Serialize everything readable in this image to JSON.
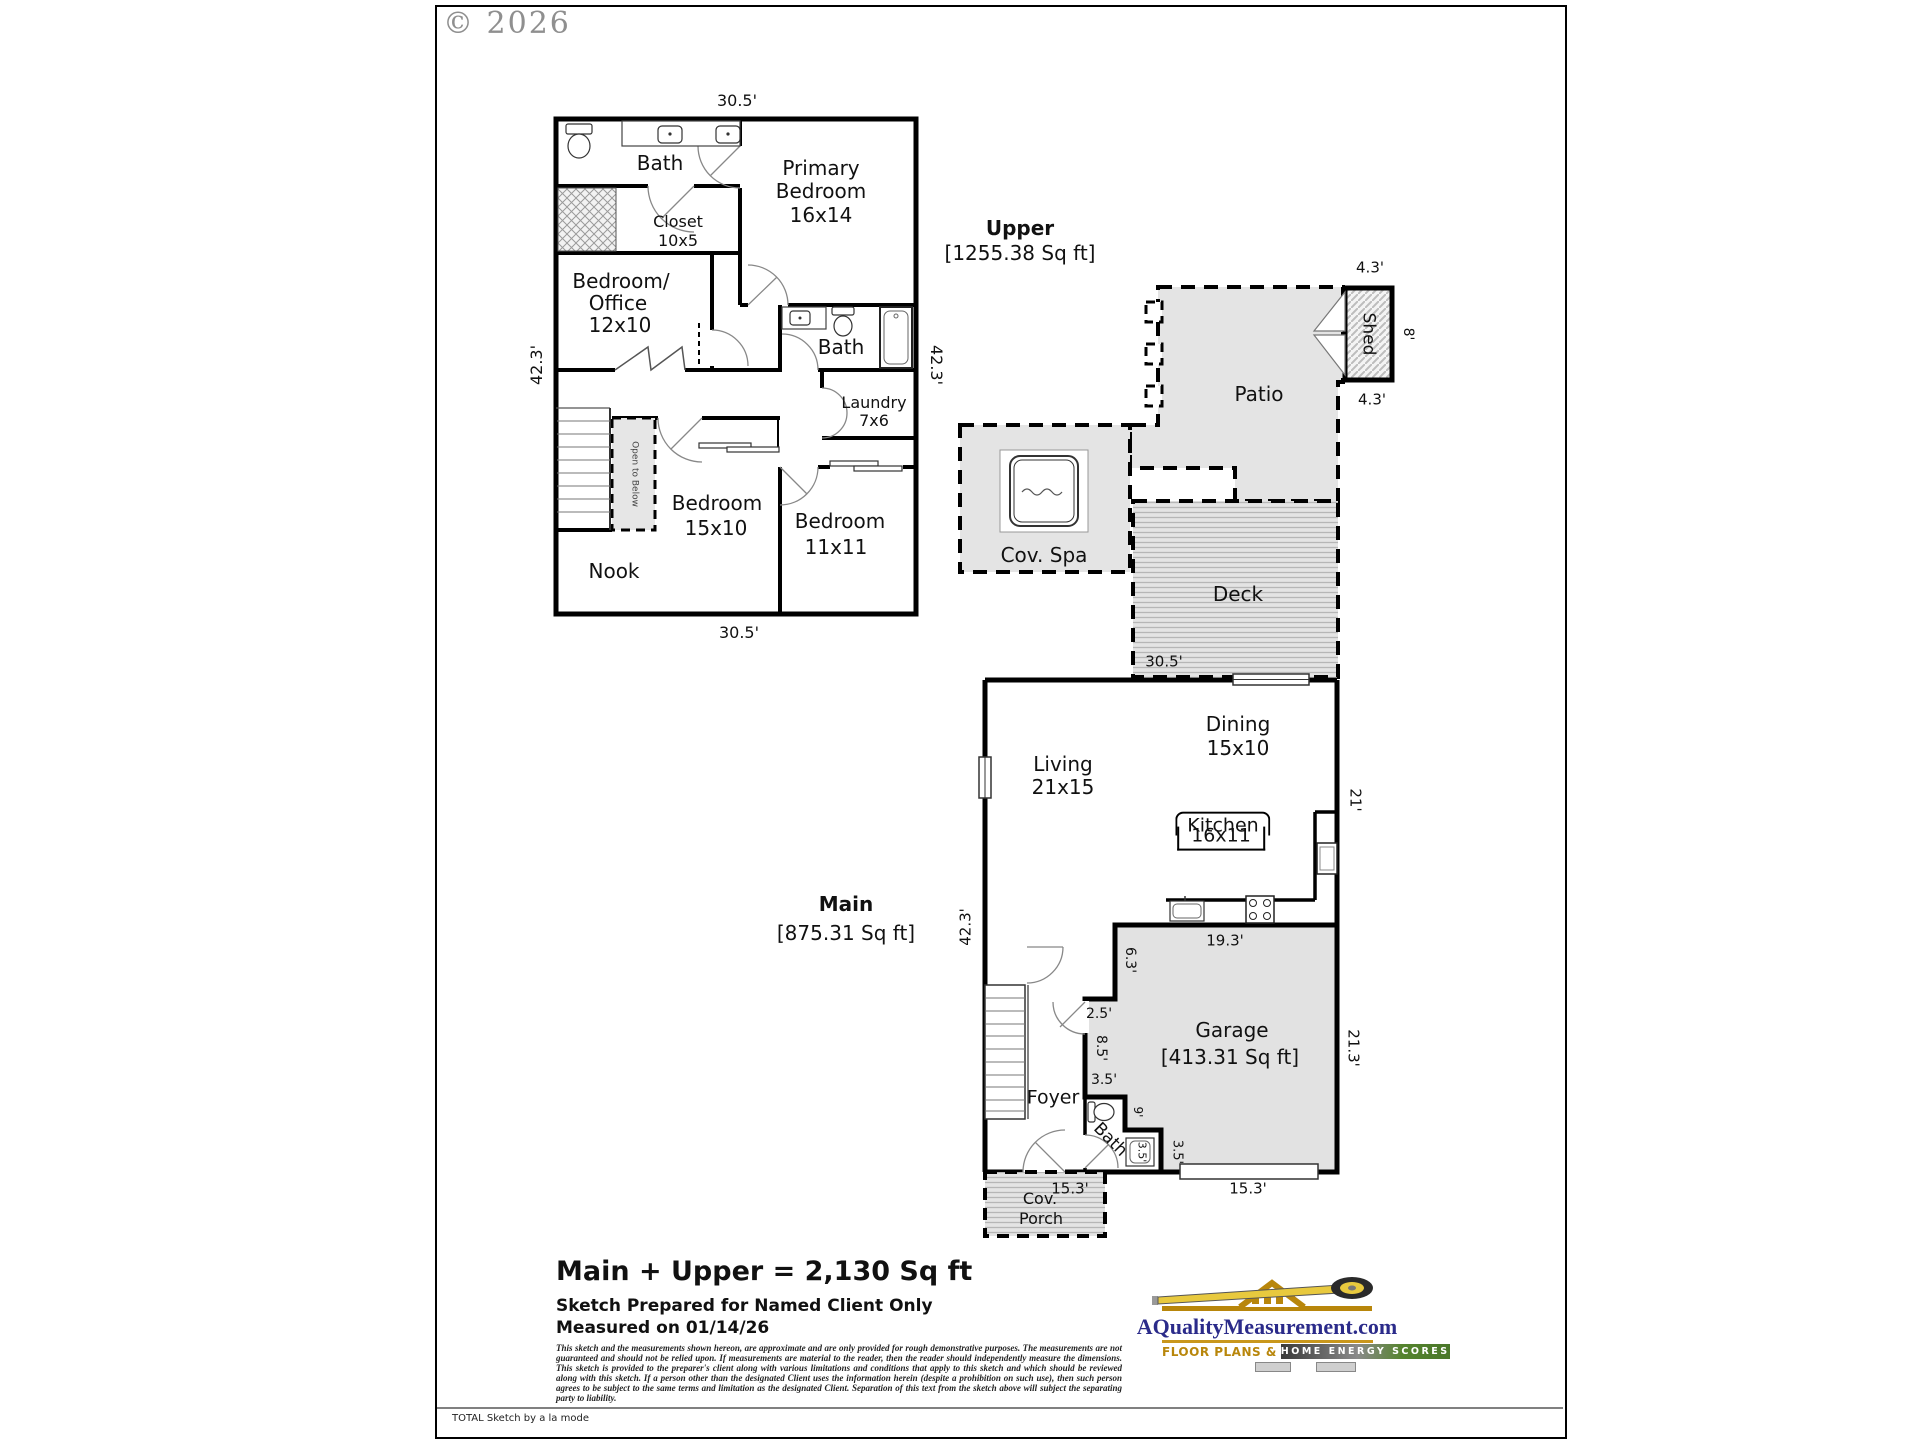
{
  "page": {
    "copyright": "© 2026",
    "footer_note": "TOTAL Sketch by a la mode"
  },
  "upper": {
    "title": "Upper",
    "sqft": "[1255.38 Sq ft]",
    "dims": {
      "top": "30.5'",
      "bottom": "30.5'",
      "left": "42.3'",
      "right": "42.3'"
    },
    "rooms": {
      "bath1": "Bath",
      "closet": "Closet",
      "closet_dim": "10x5",
      "primary1": "Primary",
      "primary2": "Bedroom",
      "primary_dim": "16x14",
      "bedoffice1": "Bedroom/",
      "bedoffice2": "Office",
      "bedoffice_dim": "12x10",
      "bath2": "Bath",
      "laundry": "Laundry",
      "laundry_dim": "7x6",
      "bedroom15": "Bedroom",
      "bedroom15_dim": "15x10",
      "bedroom11": "Bedroom",
      "bedroom11_dim": "11x11",
      "nook": "Nook",
      "open_below": "Open to Below"
    }
  },
  "outdoor": {
    "patio": "Patio",
    "shed": "Shed",
    "shed_width_top": "4.3'",
    "shed_width_bottom": "4.3'",
    "shed_depth": "8'",
    "spa": "Cov. Spa",
    "deck": "Deck",
    "deck_dim": "30.5'"
  },
  "main": {
    "title": "Main",
    "sqft": "[875.31 Sq ft]",
    "dims": {
      "left": "42.3'",
      "right_top": "21'",
      "right_bottom": "21.3'",
      "garage_top": "19.3'",
      "d63": "6.3'",
      "d25": "2.5'",
      "d85": "8.5'",
      "d35a": "3.5'",
      "d9": "9'",
      "d35b": "3.5'",
      "d35c": "3.5'",
      "porch_width": "15.3'",
      "garage_bottom": "15.3'"
    },
    "rooms": {
      "living": "Living",
      "living_dim": "21x15",
      "dining": "Dining",
      "dining_dim": "15x10",
      "kitchen": "Kitchen",
      "kitchen_dim": "16x11",
      "garage": "Garage",
      "garage_sqft": "[413.31 Sq ft]",
      "foyer": "Foyer",
      "bath": "Bath",
      "porch1": "Cov.",
      "porch2": "Porch"
    }
  },
  "footer": {
    "total": "Main + Upper = 2,130 Sq ft",
    "prepared": "Sketch Prepared for Named Client Only",
    "measured": "Measured on 01/14/26",
    "disclaimer": "This sketch and the measurements shown hereon, are approximate and are only provided for rough demonstrative purposes. The measurements are not guaranteed and should not be relied upon. If measurements are material to the reader, then the reader should independently measure the dimensions. This sketch is provided to the preparer's client along with various limitations and conditions that apply to this sketch and which should be reviewed along with this sketch. If a person other than the designated Client uses the information herein (despite a prohibition on such use), then such person agrees to be subject to the same terms and limitation as the designated Client. Separation of this text from the sketch above will subject the separating party to liability."
  },
  "logo": {
    "domain": "AQualityMeasurement.com",
    "tagline1": "FLOOR PLANS &",
    "tagline2": "HOME ENERGY SCORES"
  }
}
